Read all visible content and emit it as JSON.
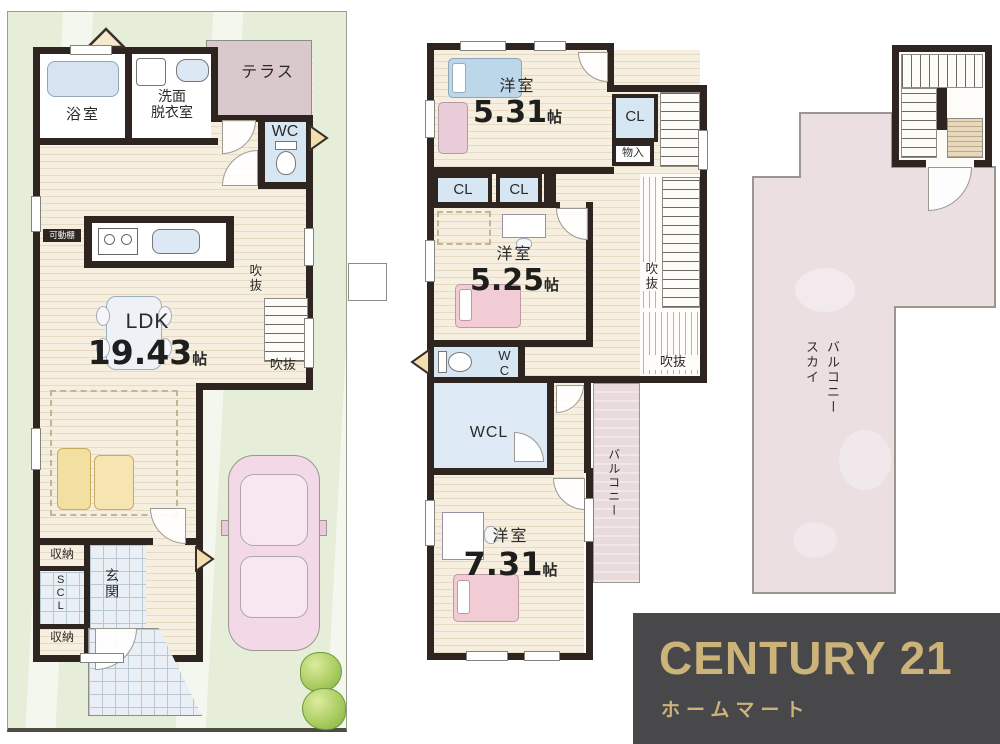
{
  "logo": {
    "brand": "CENTURY 21",
    "store": "ホームマート",
    "gold": "#cbb37a",
    "bg": "#48484a"
  },
  "f1": {
    "bath": "浴室",
    "wash1": "洗面",
    "wash2": "脱衣室",
    "terrace": "テラス",
    "wc": "WC",
    "shelf": "可動棚",
    "ldk": "LDK",
    "ldk_size": "19.43",
    "unit": "帖",
    "void_v": "吹抜",
    "void_h": "吹抜",
    "storage_top": "収納",
    "scl": "SCL",
    "genkan": "玄関",
    "storage_btm": "収納"
  },
  "f2": {
    "room_a": "洋室",
    "room_a_size": "5.31",
    "room_b": "洋室",
    "room_b_size": "5.25",
    "room_c": "洋室",
    "room_c_size": "7.31",
    "unit": "帖",
    "cl_top": "CL",
    "cl_left": "CL",
    "cl_mid": "CL",
    "mono": "物入",
    "void_v": "吹抜",
    "void_h": "吹抜",
    "wc": "WC",
    "wcl": "WCL",
    "balcony": "バルコニー"
  },
  "f3": {
    "sky1": "スカイ",
    "sky2": "バルコニー"
  }
}
